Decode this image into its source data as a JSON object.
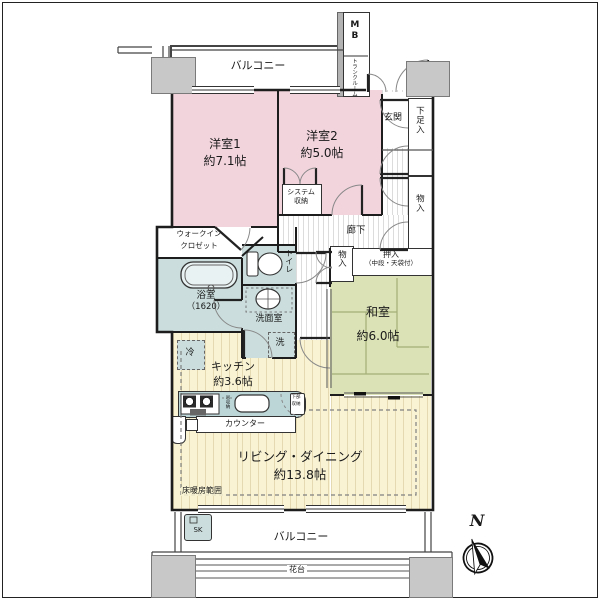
{
  "plan": {
    "balcony_top": "バルコニー",
    "balcony_bottom": "バルコニー",
    "hanadai": "花台",
    "mb": "MB",
    "trunk_room": "トランクルーム",
    "genkan": "玄関",
    "getabako": "下足入",
    "monoire_right": "物入",
    "rouka": "廊下",
    "bedroom1_name": "洋室1",
    "bedroom1_size": "約7.1帖",
    "bedroom2_name": "洋室2",
    "bedroom2_size": "約5.0帖",
    "system_storage_l1": "システム",
    "system_storage_l2": "収納",
    "wic_l1": "ウォークイン",
    "wic_l2": "クロゼット",
    "bath_name": "浴室",
    "bath_size": "（1620）",
    "toilet": "トイレ",
    "wash_room": "洗面室",
    "washer": "洗",
    "fridge": "冷",
    "kitchen_name": "キッチン",
    "kitchen_size": "約3.6帖",
    "hanging_storage": "吊収納",
    "base_storage_l1": "下部",
    "base_storage_l2": "収納",
    "counter": "カウンター",
    "monoire_mid": "物入",
    "oshiire": "押入",
    "oshiire_note": "（中段・天袋付）",
    "washitsu_name": "和室",
    "washitsu_size": "約6.0帖",
    "ld_name": "リビング・ダイニング",
    "ld_size": "約13.8帖",
    "floor_heating": "床暖房範囲",
    "sk": "SK",
    "north": "N"
  },
  "colors": {
    "bedroom_pink": "#f2d4dd",
    "tatami_green": "#dbe2b6",
    "flooring_yellow": "#f9f3d4",
    "wet_area_teal": "#cbdedd",
    "counter_teal": "#bcd6d8",
    "pillar_gray": "#c8c8c8",
    "wall": "#1d1d1d"
  }
}
